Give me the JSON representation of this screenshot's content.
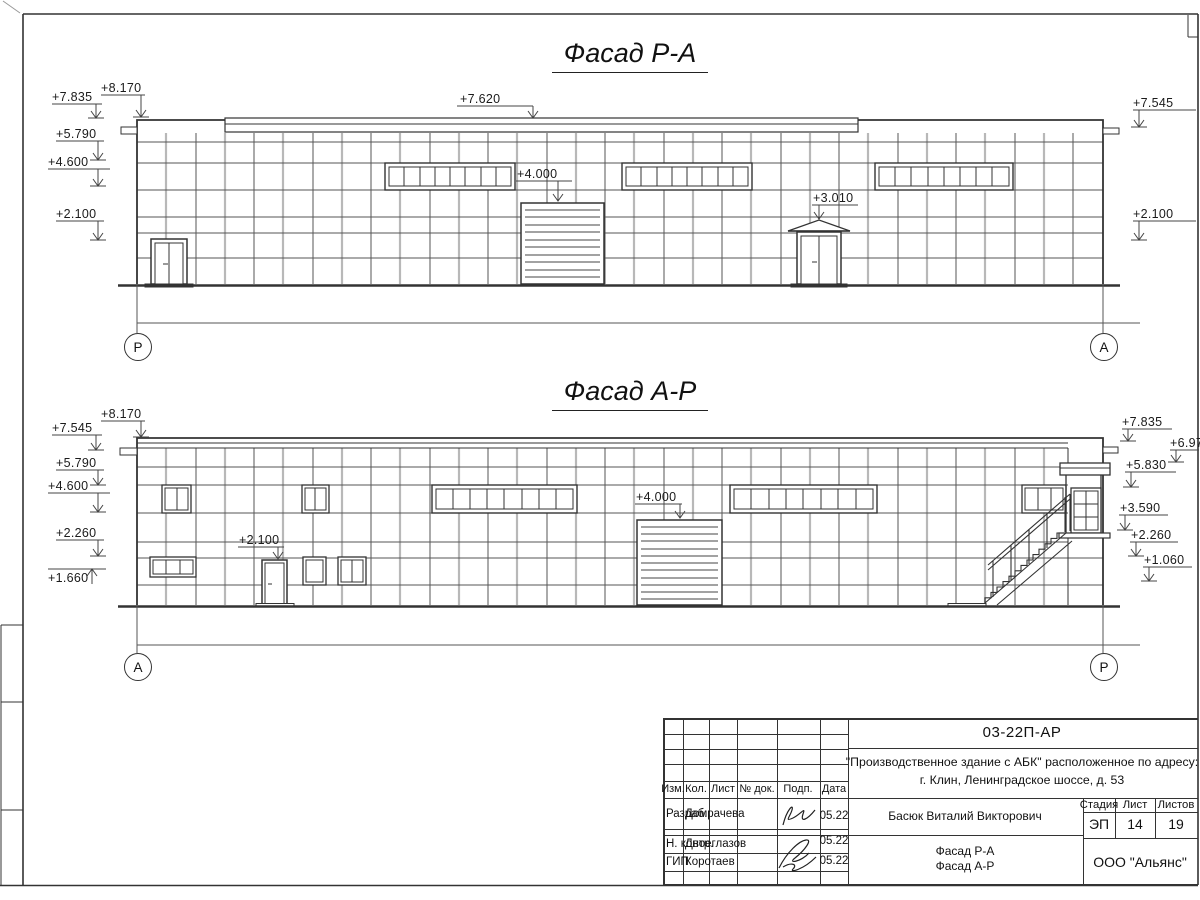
{
  "facade1": {
    "title": "Фасад Р-А",
    "axis_left": "Р",
    "axis_right": "А",
    "markers": [
      "+7.835",
      "+8.170",
      "+5.790",
      "+4.600",
      "+2.100",
      "+7.545",
      "+2.100",
      "+7.620",
      "+4.000",
      "+3.010"
    ]
  },
  "facade2": {
    "title": "Фасад А-Р",
    "axis_left": "А",
    "axis_right": "Р",
    "markers": [
      "+7.545",
      "+8.170",
      "+5.790",
      "+4.600",
      "+2.260",
      "+1.660",
      "+2.100",
      "+4.000",
      "+7.835",
      "+6.970",
      "+5.830",
      "+3.590",
      "+2.260",
      "+1.060"
    ]
  },
  "titleblock": {
    "doc_number": "03-22П-АР",
    "project_line1": "\"Производственное здание с АБК\" расположенное по адресу:",
    "project_line2": "г. Клин, Ленинградское шоссе, д. 53",
    "cols": [
      "Изм.",
      "Кол.",
      "Лист",
      "№ док.",
      "Подп.",
      "Дата"
    ],
    "roles": [
      {
        "role": "Разраб.",
        "name": "Домрачева",
        "date": "05.22"
      },
      {
        "role": "Н. контр.",
        "name": "Двоеглазов",
        "date": "05.22"
      },
      {
        "role": "ГИП",
        "name": "Коротаев",
        "date": "05.22"
      }
    ],
    "chief": "Басюк Виталий Викторович",
    "sheet_name_line1": "Фасад Р-А",
    "sheet_name_line2": "Фасад А-Р",
    "stage_label": "Стадия",
    "sheet_label": "Лист",
    "sheets_label": "Листов",
    "stage": "ЭП",
    "sheet_no": "14",
    "sheets_total": "19",
    "company": "ООО \"Альянс\""
  }
}
